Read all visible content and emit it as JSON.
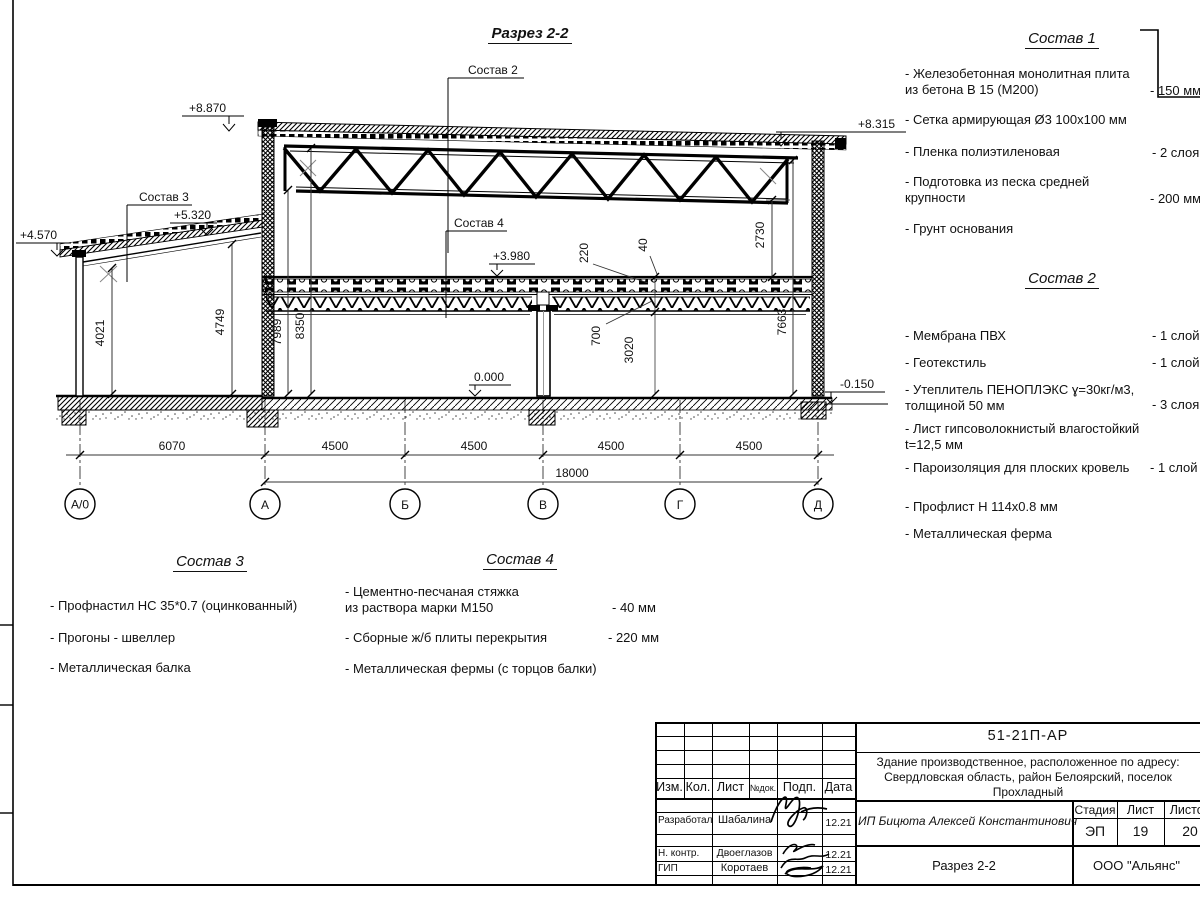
{
  "title": "Разрез 2-2",
  "drawing": {
    "elevations": {
      "e8870": "+8.870",
      "e8315": "+8.315",
      "e5320": "+5.320",
      "e4570": "+4.570",
      "e3980": "+3.980",
      "e0000": "0.000",
      "em0150": "-0.150"
    },
    "leaders": {
      "l2": "Состав 2",
      "l3": "Состав 3",
      "l4": "Состав 4"
    },
    "vdims": {
      "d4021": "4021",
      "d4749": "4749",
      "d7989": "7989",
      "d8350": "8350",
      "d220": "220",
      "d40": "40",
      "d700": "700",
      "d3020": "3020",
      "d2730": "2730",
      "d7663": "7663"
    },
    "hdims": {
      "d6070": "6070",
      "s1": "4500",
      "s2": "4500",
      "s3": "4500",
      "s4": "4500",
      "total": "18000"
    },
    "axes": [
      "А/0",
      "А",
      "Б",
      "В",
      "Г",
      "Д"
    ]
  },
  "sostav1": {
    "title": "Состав 1",
    "items": [
      {
        "name": "- Железобетонная  монолитная плита\n  из бетона В 15 (М200)",
        "value": "- 150 мм"
      },
      {
        "name": "- Сетка армирующая Ø3 100x100 мм",
        "value": ""
      },
      {
        "name": "- Пленка полиэтиленовая",
        "value": "- 2 слоя"
      },
      {
        "name": "- Подготовка из песка средней\n  крупности",
        "value": "- 200 мм"
      },
      {
        "name": "- Грунт основания",
        "value": ""
      }
    ]
  },
  "sostav2": {
    "title": "Состав 2",
    "items": [
      {
        "name": "- Мембрана ПВХ",
        "value": "- 1 слой"
      },
      {
        "name": "- Геотекстиль",
        "value": "- 1 слой"
      },
      {
        "name": "- Утеплитель ПЕНОПЛЭКС ɣ=30кг/м3,\n  толщиной 50 мм",
        "value": "- 3 слоя"
      },
      {
        "name": "- Лист гипсоволокнистый влагостойкий\n  t=12,5 мм",
        "value": ""
      },
      {
        "name": "- Пароизоляция для плоских кровель",
        "value": "- 1 слой"
      },
      {
        "name": "- Профлист Н 114х0.8 мм",
        "value": ""
      },
      {
        "name": "- Металлическая ферма",
        "value": ""
      }
    ]
  },
  "sostav3": {
    "title": "Состав 3",
    "items": [
      {
        "name": "- Профнастил НС 35*0.7 (оцинкованный)",
        "value": ""
      },
      {
        "name": "- Прогоны - швеллер",
        "value": ""
      },
      {
        "name": "- Металлическая балка",
        "value": ""
      }
    ]
  },
  "sostav4": {
    "title": "Состав 4",
    "items": [
      {
        "name": "- Цементно-песчаная стяжка\n  из раствора марки М150",
        "value": "- 40 мм"
      },
      {
        "name": "- Сборные ж/б плиты перекрытия",
        "value": "- 220 мм"
      },
      {
        "name": "- Металлическая фермы (с торцов балки)",
        "value": ""
      }
    ]
  },
  "titleblock": {
    "doc_number": "51-21П-АР",
    "project_line1": "Здание производственное, расположенное по адресу:",
    "project_line2": "Свердловская область, район Белоярский, поселок",
    "project_line3": "Прохладный",
    "cols": {
      "izm": "Изм.",
      "kol": "Кол.",
      "list": "Лист",
      "ndok": "№док.",
      "podp": "Подп.",
      "data": "Дата"
    },
    "rows": [
      {
        "role": "Разработал",
        "name": "Шабалина",
        "date": "12.21"
      },
      {
        "role": "Н. контр.",
        "name": "Двоеглазов",
        "date": "12.21"
      },
      {
        "role": "ГИП",
        "name": "Коротаев",
        "date": "12.21"
      }
    ],
    "designer": "ИП Бицюта Алексей Константинович",
    "stage_label": "Стадия",
    "list_label": "Лист",
    "listov_label": "Листов",
    "stage": "ЭП",
    "list_no": "19",
    "listov": "20",
    "drawing_name": "Разрез 2-2",
    "org": "ООО \"Альянс\""
  }
}
